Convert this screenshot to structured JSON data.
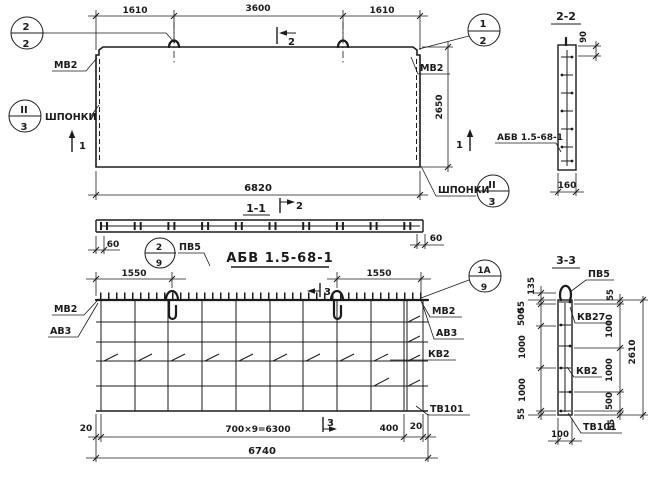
{
  "facade": {
    "dim_1610_left": "1610",
    "dim_3600": "3600",
    "dim_1610_right": "1610",
    "dim_6820": "6820",
    "dim_2650": "2650",
    "label_mv2_left": "МВ2",
    "label_mv2_right": "МВ2",
    "label_keys_left": "ШПОНКИ",
    "label_keys_right": "ШПОНКИ",
    "node_left": {
      "top": "2",
      "bottom": "2"
    },
    "node_right": {
      "top": "1",
      "bottom": "2"
    },
    "node_keys_left": {
      "top": "II",
      "bottom": "3"
    },
    "node_keys_right": {
      "top": "II",
      "bottom": "3"
    },
    "cut1_left": "1",
    "cut1_right": "1",
    "cut2_top": "2"
  },
  "section22": {
    "title": "2-2",
    "dim_90": "90",
    "dim_160": "160",
    "label_abv": "АБВ 1.5-68-1"
  },
  "section11": {
    "title": "1-1",
    "cut2": "2",
    "dim_60_left": "60",
    "dim_60_right": "60",
    "node": {
      "top": "2",
      "bottom": "9"
    },
    "label_pv5": "ПВ5",
    "main_title": "АБВ 1.5-68-1"
  },
  "mesh": {
    "dim_1550_left": "1550",
    "dim_1550_right": "1550",
    "cut3_top": "3",
    "cut3_bottom": "3",
    "node": {
      "top": "1А",
      "bottom": "9"
    },
    "label_mv2_left": "МВ2",
    "label_av3_left": "АВ3",
    "label_mv2_right": "МВ2",
    "label_av3_right": "АВ3",
    "label_kv2": "КВ2",
    "label_tv101": "ТВ101",
    "dim_20_left": "20",
    "dim_700x9": "700×9=6300",
    "dim_400": "400",
    "dim_20_right": "20",
    "dim_6740": "6740"
  },
  "section33": {
    "title": "3-3",
    "label_pv5": "ПВ5",
    "label_kv27": "КВ27",
    "label_kv2": "КВ2",
    "label_tv101": "ТВ101",
    "dim_135": "135",
    "left_55_top": "55",
    "left_500": "500",
    "left_1000_a": "1000",
    "left_1000_b": "1000",
    "left_55_bottom": "55",
    "dim_100": "100",
    "right_55_top": "55",
    "right_1000_a": "1000",
    "right_1000_b": "1000",
    "right_500": "500",
    "right_55_bottom": "55",
    "dim_2610": "2610"
  }
}
